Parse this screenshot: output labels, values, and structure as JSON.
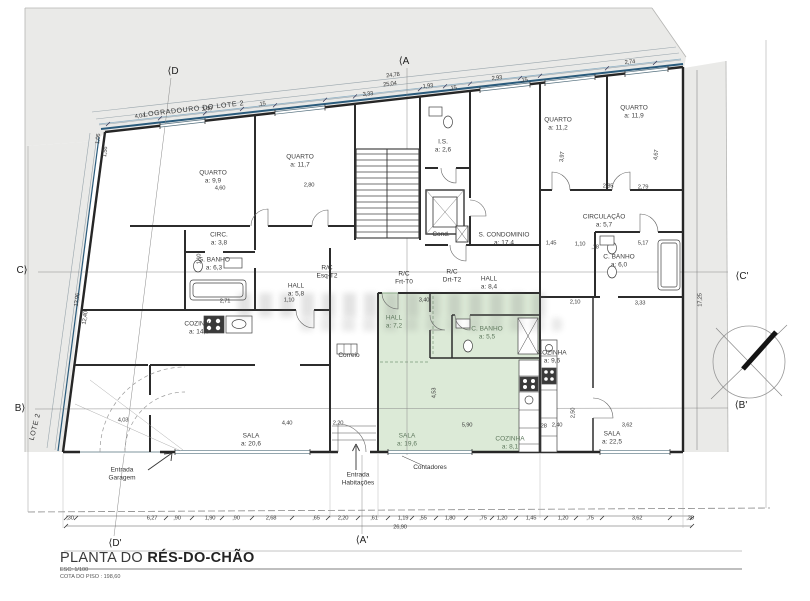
{
  "title_block": {
    "prefix": "PLANTA DO ",
    "name": "RÉS-DO-CHÃO",
    "scale": "ESC: 1/100",
    "level": "COTA DO PISO : 198,60"
  },
  "labels": {
    "rooms": [
      {
        "n": "QUARTO",
        "a": "a: 9,9",
        "x": 213,
        "y": 177
      },
      {
        "n": "QUARTO",
        "a": "a: 11,7",
        "x": 300,
        "y": 161
      },
      {
        "n": "I.S.",
        "a": "a: 2,6",
        "x": 443,
        "y": 146
      },
      {
        "n": "QUARTO",
        "a": "a: 11,2",
        "x": 558,
        "y": 124
      },
      {
        "n": "QUARTO",
        "a": "a: 11,9",
        "x": 634,
        "y": 112
      },
      {
        "n": "CIRC.",
        "a": "a: 3,8",
        "x": 219,
        "y": 239
      },
      {
        "n": "G. BANHO",
        "a": "a: 6,3",
        "x": 214,
        "y": 264
      },
      {
        "n": "HALL",
        "a": "a: 5,8",
        "x": 296,
        "y": 290
      },
      {
        "n": "CIRCULAÇÃO",
        "a": "a: 5,7",
        "x": 604,
        "y": 221
      },
      {
        "n": "S. CONDOMINIO",
        "a": "a: 17,4",
        "x": 504,
        "y": 239
      },
      {
        "n": "C. BANHO",
        "a": "a: 6,0",
        "x": 619,
        "y": 261
      },
      {
        "n": "HALL",
        "a": "a: 8,4",
        "x": 489,
        "y": 283
      },
      {
        "n": "COZINHA",
        "a": "a: 14,6",
        "x": 199,
        "y": 328
      },
      {
        "n": "HALL",
        "a": "a: 7,2",
        "x": 394,
        "y": 322,
        "g": 1
      },
      {
        "n": "C. BANHO",
        "a": "a: 5,5",
        "x": 487,
        "y": 333,
        "g": 1
      },
      {
        "n": "COZINHA",
        "a": "a: 9,6",
        "x": 552,
        "y": 357
      },
      {
        "n": "SALA",
        "a": "a: 20,6",
        "x": 251,
        "y": 440
      },
      {
        "n": "SALA",
        "a": "a: 19,6",
        "x": 407,
        "y": 440,
        "g": 1
      },
      {
        "n": "COZINHA",
        "a": "a: 8,1",
        "x": 510,
        "y": 443,
        "g": 1
      },
      {
        "n": "SALA",
        "a": "a: 22,5",
        "x": 612,
        "y": 438
      }
    ],
    "units": [
      {
        "t": "R/C\nEsq-T2",
        "x": 327,
        "y": 272
      },
      {
        "t": "R/C\nFrt-T0",
        "x": 404,
        "y": 278
      },
      {
        "t": "R/C\nDrt-T2",
        "x": 452,
        "y": 276
      }
    ],
    "notes": [
      {
        "t": "Cond.",
        "x": 441,
        "y": 235
      },
      {
        "t": "Correio",
        "x": 349,
        "y": 356
      },
      {
        "t": "Contadores",
        "x": 430,
        "y": 468
      },
      {
        "t": "Entrada\nGaragem",
        "x": 122,
        "y": 474
      },
      {
        "t": "Entrada\nHabitações",
        "x": 358,
        "y": 479
      }
    ],
    "site": [
      {
        "t": "LOGRADOURO DO LOTE 2",
        "x": 194,
        "y": 110,
        "r": -6.5
      },
      {
        "t": "LOTE 2",
        "x": 36,
        "y": 427,
        "r": -76
      }
    ],
    "sections": [
      {
        "t": "⟨A",
        "x": 404,
        "y": 62
      },
      {
        "t": "⟨A'",
        "x": 362,
        "y": 541
      },
      {
        "t": "⟨D",
        "x": 173,
        "y": 72
      },
      {
        "t": "⟨D'",
        "x": 115,
        "y": 544
      },
      {
        "t": "C⟩",
        "x": 22,
        "y": 271
      },
      {
        "t": "⟨C'",
        "x": 742,
        "y": 277
      },
      {
        "t": "B⟩",
        "x": 20,
        "y": 409
      },
      {
        "t": "⟨B'",
        "x": 741,
        "y": 406
      }
    ],
    "dims": [
      {
        "t": "4,04",
        "x": 140,
        "y": 117,
        "r": -6.4
      },
      {
        "t": "3,40",
        "x": 207,
        "y": 110,
        "r": -6.4
      },
      {
        "t": ",15",
        "x": 262,
        "y": 105,
        "r": -6.4
      },
      {
        "t": "3,33",
        "x": 368,
        "y": 95,
        "r": -6.4
      },
      {
        "t": "1,93",
        "x": 428,
        "y": 87,
        "r": -6.4
      },
      {
        "t": ",15",
        "x": 453,
        "y": 89,
        "r": -6.4
      },
      {
        "t": "2,93",
        "x": 497,
        "y": 79,
        "r": -6.4
      },
      {
        "t": ",15",
        "x": 524,
        "y": 81,
        "r": -6.4
      },
      {
        "t": "2,74",
        "x": 630,
        "y": 63,
        "r": -6.4
      },
      {
        "t": "25,04",
        "x": 390,
        "y": 85,
        "r": -6.4
      },
      {
        "t": "24,78",
        "x": 393,
        "y": 76,
        "r": -6.4
      },
      {
        "t": "1,06",
        "x": 99,
        "y": 139,
        "r": -83
      },
      {
        "t": "1,56",
        "x": 106,
        "y": 152,
        "r": -83
      },
      {
        "t": "13,96",
        "x": 78,
        "y": 300,
        "r": -82
      },
      {
        "t": "12,40",
        "x": 86,
        "y": 318,
        "r": -82
      },
      {
        "t": "17,25",
        "x": 701,
        "y": 300,
        "r": -90
      },
      {
        "t": "4,60",
        "x": 220,
        "y": 189
      },
      {
        "t": "2,80",
        "x": 309,
        "y": 186
      },
      {
        "t": "2,85",
        "x": 608,
        "y": 187
      },
      {
        "t": "2,79",
        "x": 643,
        "y": 188
      },
      {
        "t": "3,97",
        "x": 563,
        "y": 157,
        "r": -84
      },
      {
        "t": "4,67",
        "x": 657,
        "y": 155,
        "r": -84
      },
      {
        "t": "1,45",
        "x": 551,
        "y": 244
      },
      {
        "t": "1,10",
        "x": 580,
        "y": 245
      },
      {
        "t": "5,17",
        "x": 643,
        "y": 244
      },
      {
        "t": "2,71",
        "x": 225,
        "y": 302
      },
      {
        "t": "1,10",
        "x": 289,
        "y": 301
      },
      {
        "t": "3,40",
        "x": 424,
        "y": 301
      },
      {
        "t": "2,10",
        "x": 575,
        "y": 303
      },
      {
        "t": "3,33",
        "x": 640,
        "y": 304
      },
      {
        "t": "1,10",
        "x": 200,
        "y": 259,
        "r": -90
      },
      {
        "t": "4,53",
        "x": 435,
        "y": 393,
        "r": -90
      },
      {
        "t": "2,50",
        "x": 574,
        "y": 413,
        "r": -90
      },
      {
        "t": "5,90",
        "x": 467,
        "y": 426
      },
      {
        "t": "4,40",
        "x": 287,
        "y": 424
      },
      {
        "t": "2,20",
        "x": 338,
        "y": 424
      },
      {
        "t": "2,40",
        "x": 557,
        "y": 426
      },
      {
        "t": "3,62",
        "x": 627,
        "y": 426
      },
      {
        "t": "4,03",
        "x": 123,
        "y": 421
      },
      {
        "t": ",18",
        "x": 595,
        "y": 248
      },
      {
        "t": ",28",
        "x": 543,
        "y": 427
      },
      {
        "t": ",30",
        "x": 70,
        "y": 519
      },
      {
        "t": "6,27",
        "x": 152,
        "y": 519
      },
      {
        "t": ",90",
        "x": 177,
        "y": 519
      },
      {
        "t": "1,90",
        "x": 210,
        "y": 519
      },
      {
        "t": ",90",
        "x": 236,
        "y": 519
      },
      {
        "t": "2,68",
        "x": 271,
        "y": 519
      },
      {
        "t": ",65",
        "x": 316,
        "y": 519
      },
      {
        "t": "2,20",
        "x": 343,
        "y": 519
      },
      {
        "t": ",61",
        "x": 374,
        "y": 519
      },
      {
        "t": "1,19",
        "x": 403,
        "y": 519
      },
      {
        "t": ",55",
        "x": 423,
        "y": 519
      },
      {
        "t": "1,80",
        "x": 450,
        "y": 519
      },
      {
        "t": ",75",
        "x": 483,
        "y": 519
      },
      {
        "t": "1,20",
        "x": 502,
        "y": 519
      },
      {
        "t": "1,45",
        "x": 531,
        "y": 519
      },
      {
        "t": "1,20",
        "x": 563,
        "y": 519
      },
      {
        "t": ",75",
        "x": 590,
        "y": 519
      },
      {
        "t": "3,62",
        "x": 637,
        "y": 519
      },
      {
        "t": ",30",
        "x": 690,
        "y": 519
      },
      {
        "t": "26,90",
        "x": 400,
        "y": 528
      }
    ]
  }
}
